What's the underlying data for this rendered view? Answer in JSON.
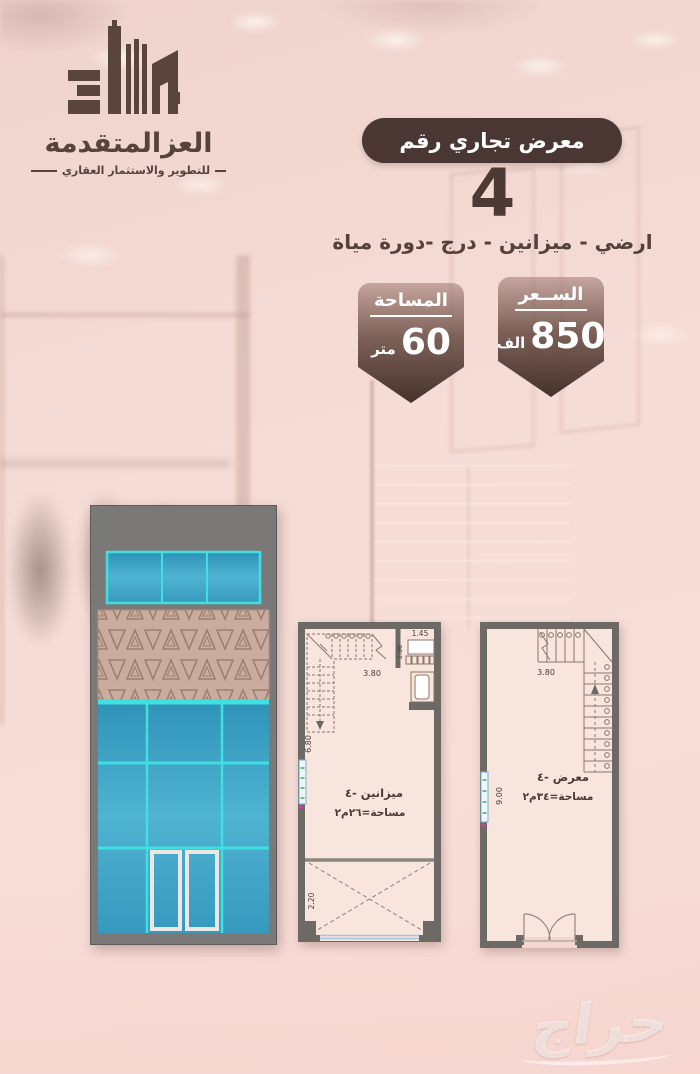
{
  "logo": {
    "title": "العزالمتقدمة",
    "tagline": "للتطوير والاستثمار العقاري"
  },
  "header": {
    "banner": "معرض تجاري رقم",
    "unit_number": "4",
    "features": "ارضي - ميزانين - درج -دورة مياة"
  },
  "badges": {
    "area": {
      "label": "المساحة",
      "value": "60",
      "unit": "متر"
    },
    "price": {
      "label": "الســعر",
      "value": "850",
      "unit": "الف"
    }
  },
  "plans": {
    "mezzanine": {
      "name": "ميزانين -٤",
      "area": "مساحة=٢٦م٢",
      "dims": {
        "bath_width": "1.45",
        "bath_depth": "1.00",
        "inner_width": "3.80",
        "side_height": "6.80",
        "void_depth": "2.20"
      }
    },
    "ground": {
      "name": "معرض -٤",
      "area": "مساحة=٣٤م٢",
      "dims": {
        "inner_width": "3.80",
        "side_height": "9.00"
      }
    }
  },
  "watermark": {
    "text": "حراج"
  },
  "colors": {
    "brand_brown": "#57433c",
    "banner_bg": "#4a3733",
    "badge_dark": "#3f2d27",
    "glass_blue": "#3a9ec4",
    "mullion_cyan": "#3fe0df",
    "frame_grey": "#7b7977",
    "wall_grey": "#6d6a66",
    "plan_fill": "#f8e5de",
    "plan_line": "#8d7567",
    "window_marker_green": "#3db54a"
  }
}
